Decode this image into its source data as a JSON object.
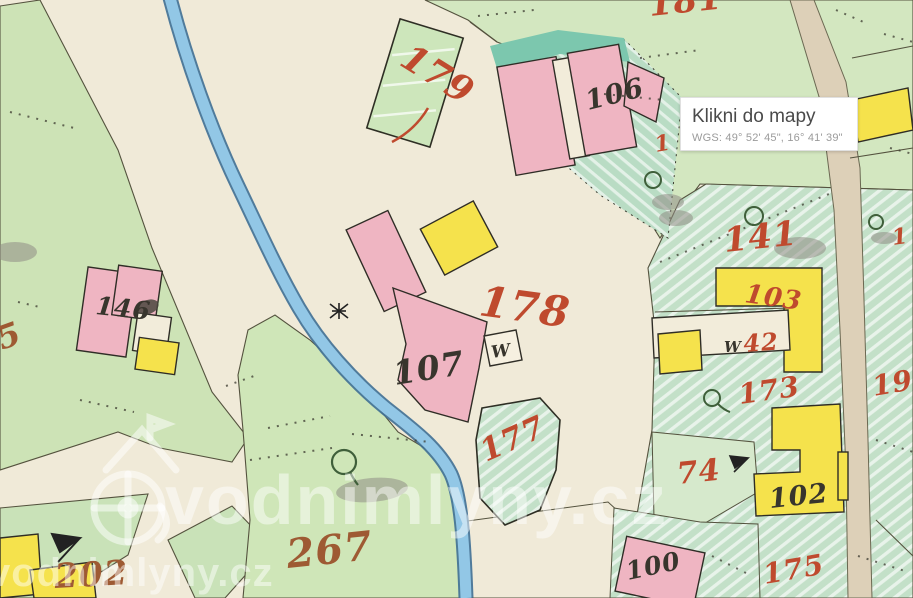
{
  "tooltip": {
    "title": "Klikni do mapy",
    "coords": "WGS: 49° 52' 45\", 16° 41' 39\""
  },
  "watermark": {
    "brand": "vodnimlyny.cz"
  },
  "palette": {
    "red_label": "#bf4a2e",
    "brown_label": "#9e5a33",
    "black_label": "#38352d",
    "building_pink": "#efb5c2",
    "building_yellow": "#f5e24c",
    "water_blue": "#92c7e6",
    "water_edge": "#3e6f95",
    "meadow_green": "#cfe5ba",
    "hatch_green": "#c3e0c8",
    "teal_band": "#7cc7ae",
    "road_cream": "#f0ead8",
    "road_tan": "#ddd0b8"
  },
  "map_labels": [
    {
      "text": "181",
      "color": "red",
      "x": 650,
      "y": 16,
      "size": 34,
      "rot": -6
    },
    {
      "text": "179",
      "color": "red",
      "x": 398,
      "y": 64,
      "size": 36,
      "rot": 32
    },
    {
      "text": "106",
      "color": "black",
      "x": 588,
      "y": 110,
      "size": 27,
      "rot": -14
    },
    {
      "text": "1",
      "color": "red",
      "x": 656,
      "y": 152,
      "size": 22,
      "rot": -10
    },
    {
      "text": "146",
      "color": "black",
      "x": 95,
      "y": 314,
      "size": 25,
      "rot": 6
    },
    {
      "text": "5",
      "color": "brown",
      "x": 2,
      "y": 350,
      "size": 32,
      "rot": -20
    },
    {
      "text": "141",
      "color": "red",
      "x": 725,
      "y": 252,
      "size": 34,
      "rot": -6
    },
    {
      "text": "1",
      "color": "red",
      "x": 893,
      "y": 245,
      "size": 22,
      "rot": -8
    },
    {
      "text": "178",
      "color": "red",
      "x": 478,
      "y": 315,
      "size": 42,
      "rot": 8
    },
    {
      "text": "103",
      "color": "red",
      "x": 744,
      "y": 302,
      "size": 26,
      "rot": 8
    },
    {
      "text": "107",
      "color": "black",
      "x": 395,
      "y": 385,
      "size": 33,
      "rot": -9
    },
    {
      "text": "W",
      "color": "black",
      "x": 492,
      "y": 358,
      "size": 17,
      "rot": -8
    },
    {
      "text": "W",
      "color": "black",
      "x": 724,
      "y": 352,
      "size": 15,
      "rot": 0
    },
    {
      "text": "42",
      "color": "red",
      "x": 744,
      "y": 352,
      "size": 24,
      "rot": -4
    },
    {
      "text": "173",
      "color": "red",
      "x": 740,
      "y": 404,
      "size": 28,
      "rot": -8
    },
    {
      "text": "19",
      "color": "red",
      "x": 874,
      "y": 396,
      "size": 28,
      "rot": -10
    },
    {
      "text": "177",
      "color": "red",
      "x": 486,
      "y": 462,
      "size": 31,
      "rot": -24
    },
    {
      "text": "74",
      "color": "red",
      "x": 678,
      "y": 484,
      "size": 30,
      "rot": -6
    },
    {
      "text": "102",
      "color": "black",
      "x": 770,
      "y": 508,
      "size": 27,
      "rot": -6
    },
    {
      "text": "267",
      "color": "brown",
      "x": 288,
      "y": 568,
      "size": 40,
      "rot": -6
    },
    {
      "text": "202",
      "color": "brown",
      "x": 55,
      "y": 588,
      "size": 34,
      "rot": -3
    },
    {
      "text": "100",
      "color": "black",
      "x": 628,
      "y": 580,
      "size": 25,
      "rot": -12
    },
    {
      "text": "175",
      "color": "red",
      "x": 765,
      "y": 584,
      "size": 28,
      "rot": -10
    }
  ]
}
